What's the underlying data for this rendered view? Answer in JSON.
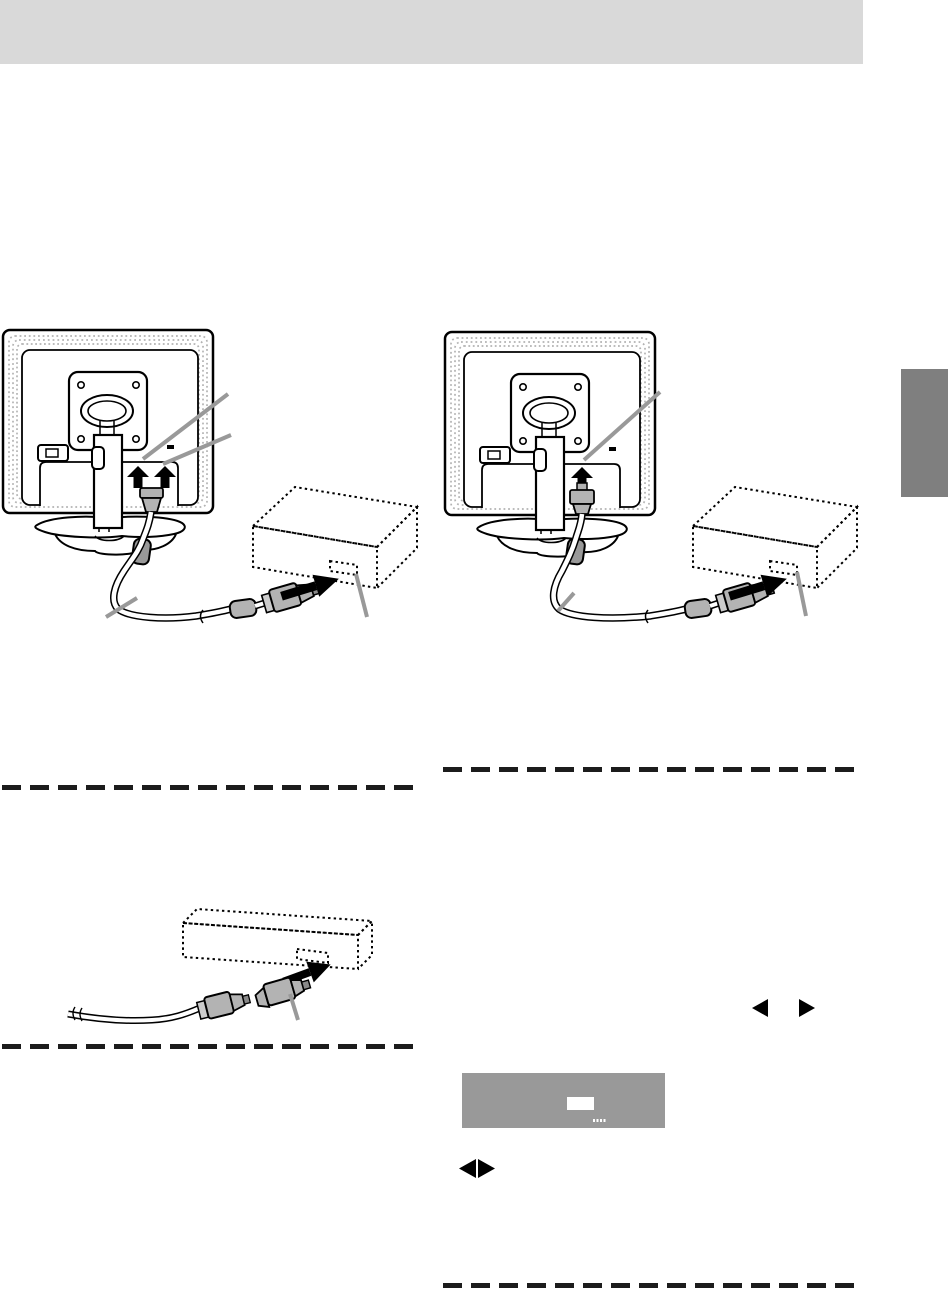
{
  "page": {
    "kind": "monitor-setup-manual-page",
    "width": 948,
    "height": 1293,
    "background": "#ffffff"
  },
  "header_bar": {
    "color": "#d9d9d9"
  },
  "side_tab": {
    "color": "#7f7f7f"
  },
  "colors": {
    "ink": "#000000",
    "callout": "#999999",
    "stipple": "#b3b3b3",
    "connector_gray": "#b3b3b3",
    "clamp_gray": "#999999",
    "dashed_rule": "#1c1c1c",
    "osd_background": "#999999",
    "osd_highlight": "#ffffff"
  },
  "columns": {
    "left": {
      "heading": ""
    },
    "right": {
      "heading": ""
    }
  },
  "osd_screen": {
    "background": "#999999",
    "highlight_color": "#ffffff",
    "dots_count": 4
  },
  "controls": {
    "left_arrow_glyph": "◀",
    "right_arrow_glyph": "▶"
  }
}
